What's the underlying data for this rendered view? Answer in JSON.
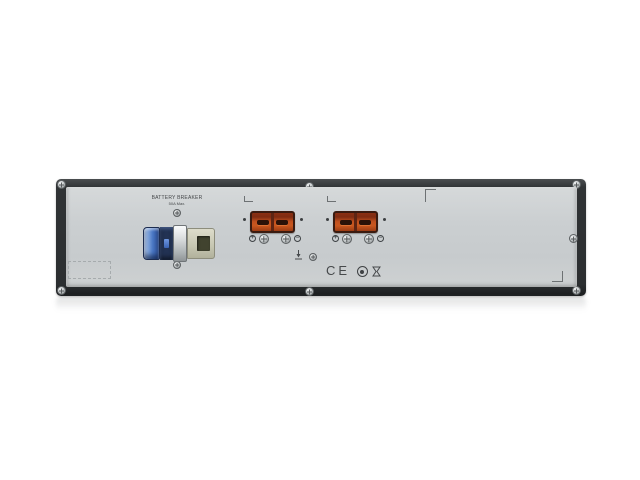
{
  "device": {
    "breaker": {
      "label_line1": "BATTERY BREAKER",
      "label_line2": "50A Max."
    },
    "battery_connectors": {
      "count": 2,
      "terminal_plus": "+",
      "terminal_minus": "−"
    },
    "certifications": {
      "ce_label": "CE",
      "marks": [
        "CE",
        "round-certification-mark",
        "hourglass-certification-mark"
      ]
    },
    "icons": {
      "ground": "earth-ground-icon",
      "screws": "phillips-screw-icon"
    },
    "colors": {
      "bezel": "#2e3133",
      "panel": "#cbcfd1",
      "connector_orange": "#c1511f",
      "connector_frame": "#3a1b10",
      "breaker_blue": "#4a77c4",
      "breaker_beige": "#c9c9b4",
      "silkscreen": "#46494b",
      "background": "#ffffff"
    }
  }
}
